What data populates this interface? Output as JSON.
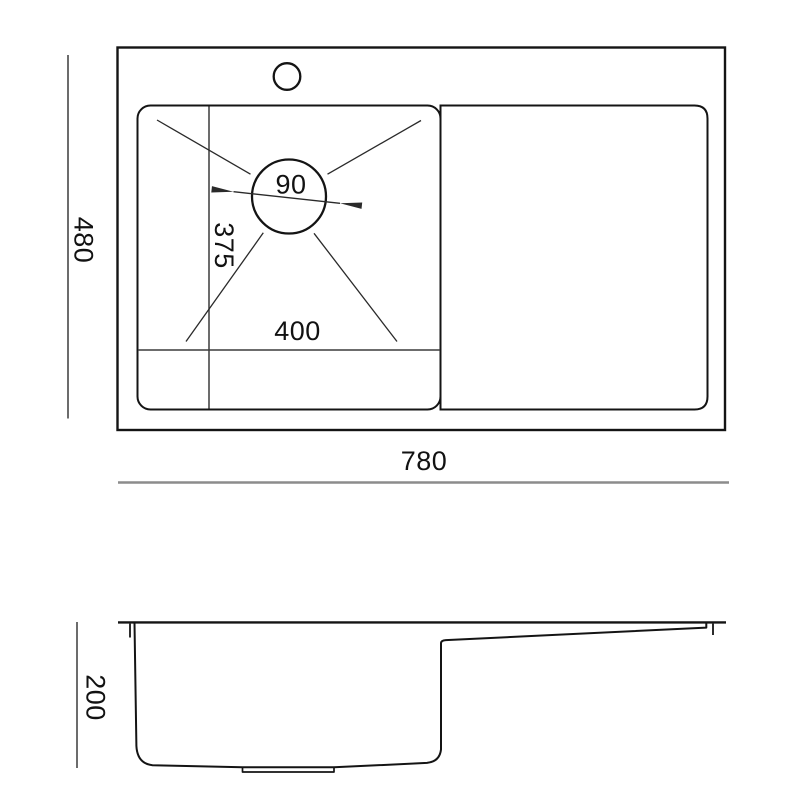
{
  "palette": {
    "background": "#ffffff",
    "main_line": "#141414",
    "dimension_line": "#3c3c3c",
    "ruler_line": "#8c8c8c",
    "text": "#121212"
  },
  "top_view": {
    "overall_width_label": "780",
    "overall_depth_label": "480",
    "bowl_width_label": "400",
    "bowl_depth_label": "375",
    "drain_diameter_label": "90"
  },
  "side_view": {
    "height_label": "200"
  }
}
